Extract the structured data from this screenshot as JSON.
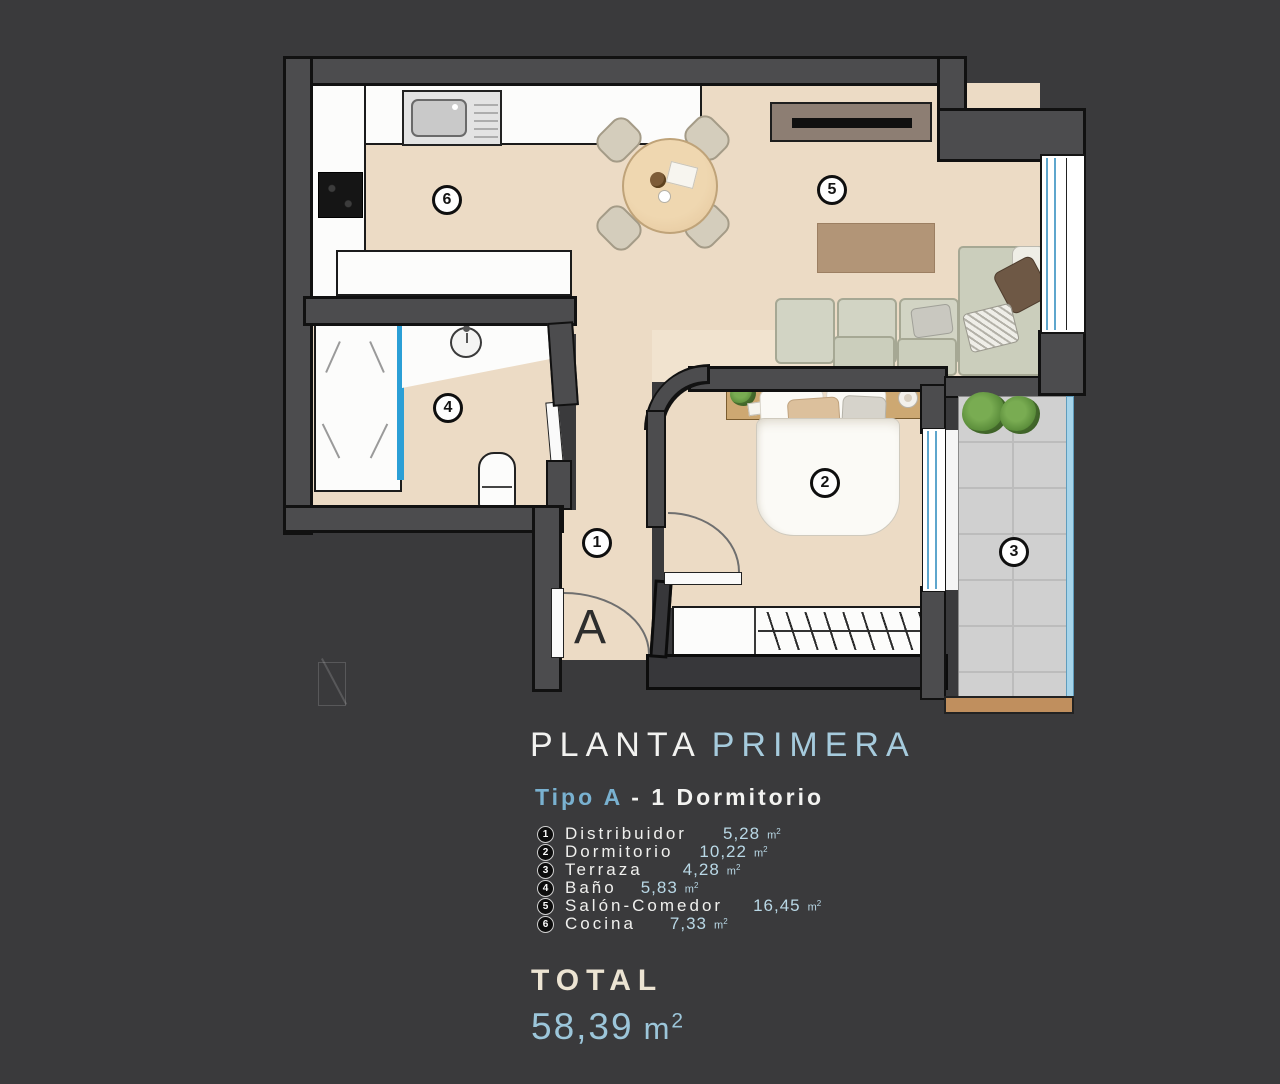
{
  "palette": {
    "background": "#3a3a3c",
    "wall_gray": "#4c4c4e",
    "floor_beige": "#ecdbc5",
    "terrace_tile": "#d0d0d0",
    "window_blue": "#5ea6cd",
    "shower_glass_blue": "#2b9fd6",
    "terrace_rail_blue": "#a6d4ea",
    "wood_tan": "#c08f5e",
    "accent_blue_light": "#a6cbdd",
    "accent_blue": "#79b1d0",
    "area_blue": "#b9d8e6",
    "total_cream": "#ece4d3",
    "total_blue": "#9cc6da"
  },
  "plan": {
    "entrance_label": "A",
    "markers": [
      {
        "num": "1"
      },
      {
        "num": "2"
      },
      {
        "num": "3"
      },
      {
        "num": "4"
      },
      {
        "num": "5"
      },
      {
        "num": "6"
      }
    ]
  },
  "title": {
    "part1": "PLANTA",
    "part2": "PRIMERA"
  },
  "subtitle": {
    "part1": "Tipo A",
    "part2": "- 1 Dormitorio"
  },
  "legend": {
    "unit_base": "m",
    "unit_sup": "2",
    "items": [
      {
        "num": "1",
        "name": "Distribuidor",
        "area": "5,28"
      },
      {
        "num": "2",
        "name": "Dormitorio",
        "area": "10,22"
      },
      {
        "num": "3",
        "name": "Terraza",
        "area": "4,28"
      },
      {
        "num": "4",
        "name": "Baño",
        "area": "5,83"
      },
      {
        "num": "5",
        "name": "Salón-Comedor",
        "area": "16,45"
      },
      {
        "num": "6",
        "name": "Cocina",
        "area": "7,33"
      }
    ]
  },
  "total": {
    "label": "TOTAL",
    "value": "58,39",
    "unit_base": "m",
    "unit_sup": "2"
  }
}
